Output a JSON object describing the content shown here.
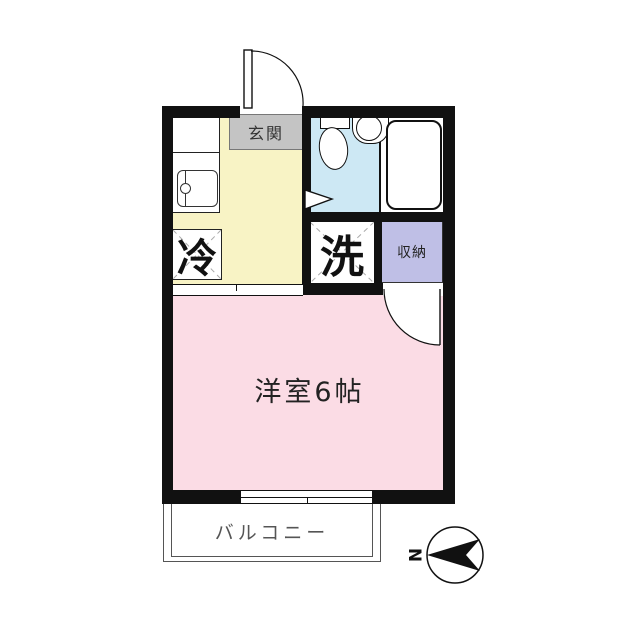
{
  "plan": {
    "entrance_label": "玄関",
    "fridge_label": "冷",
    "washer_label": "洗",
    "storage_label": "収納",
    "main_room_label": "洋室6帖",
    "balcony_label": "バルコニー",
    "compass_label": "N"
  },
  "colors": {
    "wall": "#111111",
    "kitchen_floor": "#F8F3C5",
    "main_room_floor": "#FBDCE5",
    "bathroom_floor": "#CDE8F4",
    "storage_fill": "#BFBFE6",
    "entrance_fill": "#C4C4C4"
  }
}
